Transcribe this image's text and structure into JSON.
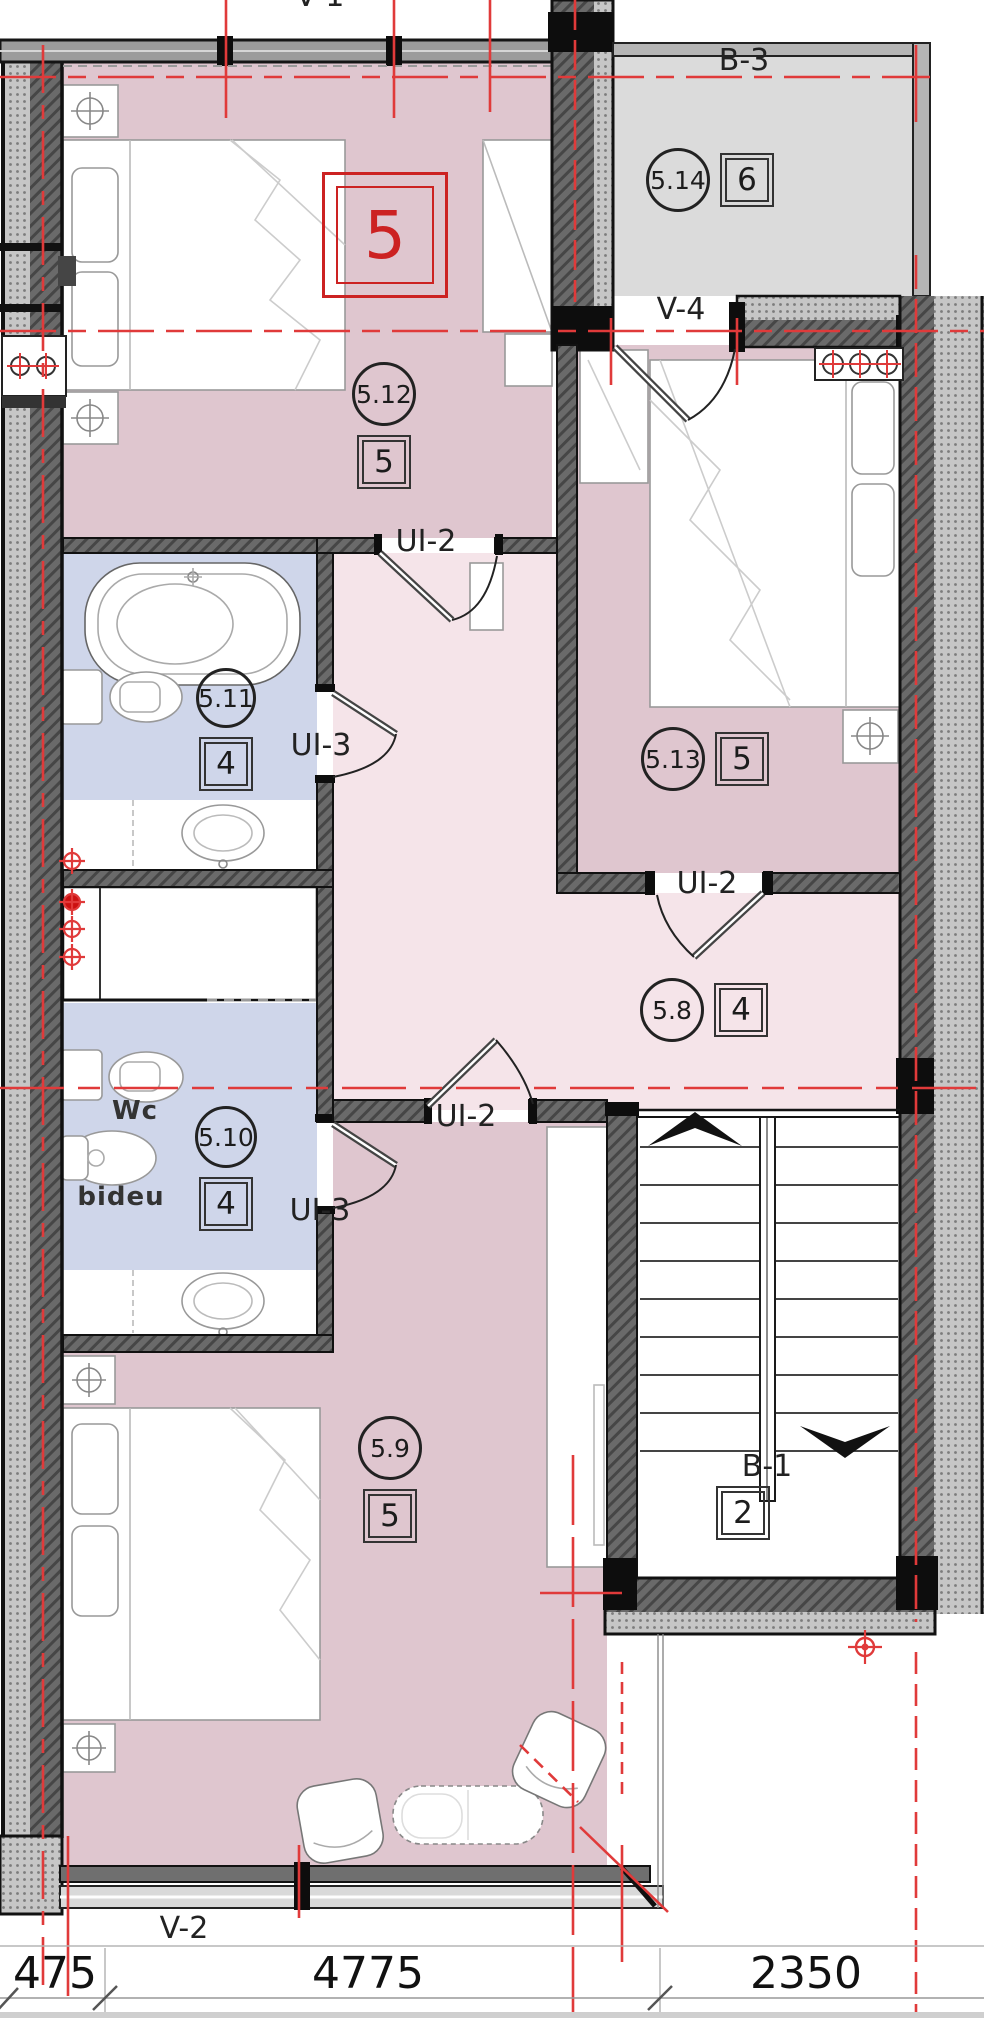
{
  "labels": {
    "window_top": "V-1",
    "balcony_top": "B-3",
    "balcony_door": "V-4",
    "window_bottom": "V-2",
    "stair_balcony": "B-1",
    "unit": "5",
    "doors": {
      "ui2_bedroom": "UI-2",
      "ui3_bath_top": "UI-3",
      "ui2_room513": "UI-2",
      "ui2_hall": "UI-2",
      "ui3_bath_bottom": "UI-3"
    },
    "fixtures": {
      "wc": "Wc",
      "bidet": "bideu"
    }
  },
  "rooms": {
    "balcony_top": {
      "number": "5.14",
      "area_index": "6"
    },
    "bedroom_top": {
      "number": "5.12",
      "area_index": "5"
    },
    "bath_top": {
      "number": "5.11",
      "area_index": "4"
    },
    "bedroom_right": {
      "number": "5.13",
      "area_index": "5"
    },
    "hall": {
      "number": "5.8",
      "area_index": "4"
    },
    "bath_bottom": {
      "number": "5.10",
      "area_index": "4"
    },
    "living_bottom": {
      "number": "5.9",
      "area_index": "5"
    },
    "stair_balcony": {
      "area_index": "2"
    }
  },
  "dimensions": {
    "left": "475",
    "middle": "4775",
    "right": "2350"
  },
  "colors": {
    "bedroom": "#dfc6cf",
    "hall": "#f5e4e9",
    "bath": "#cfd6ea",
    "balcony": "#dbdbdb",
    "wall": "#5f5f5f",
    "insulation": "#c9c9c9",
    "accent_red": "#cc2222",
    "centerline": "#e03a3a"
  }
}
